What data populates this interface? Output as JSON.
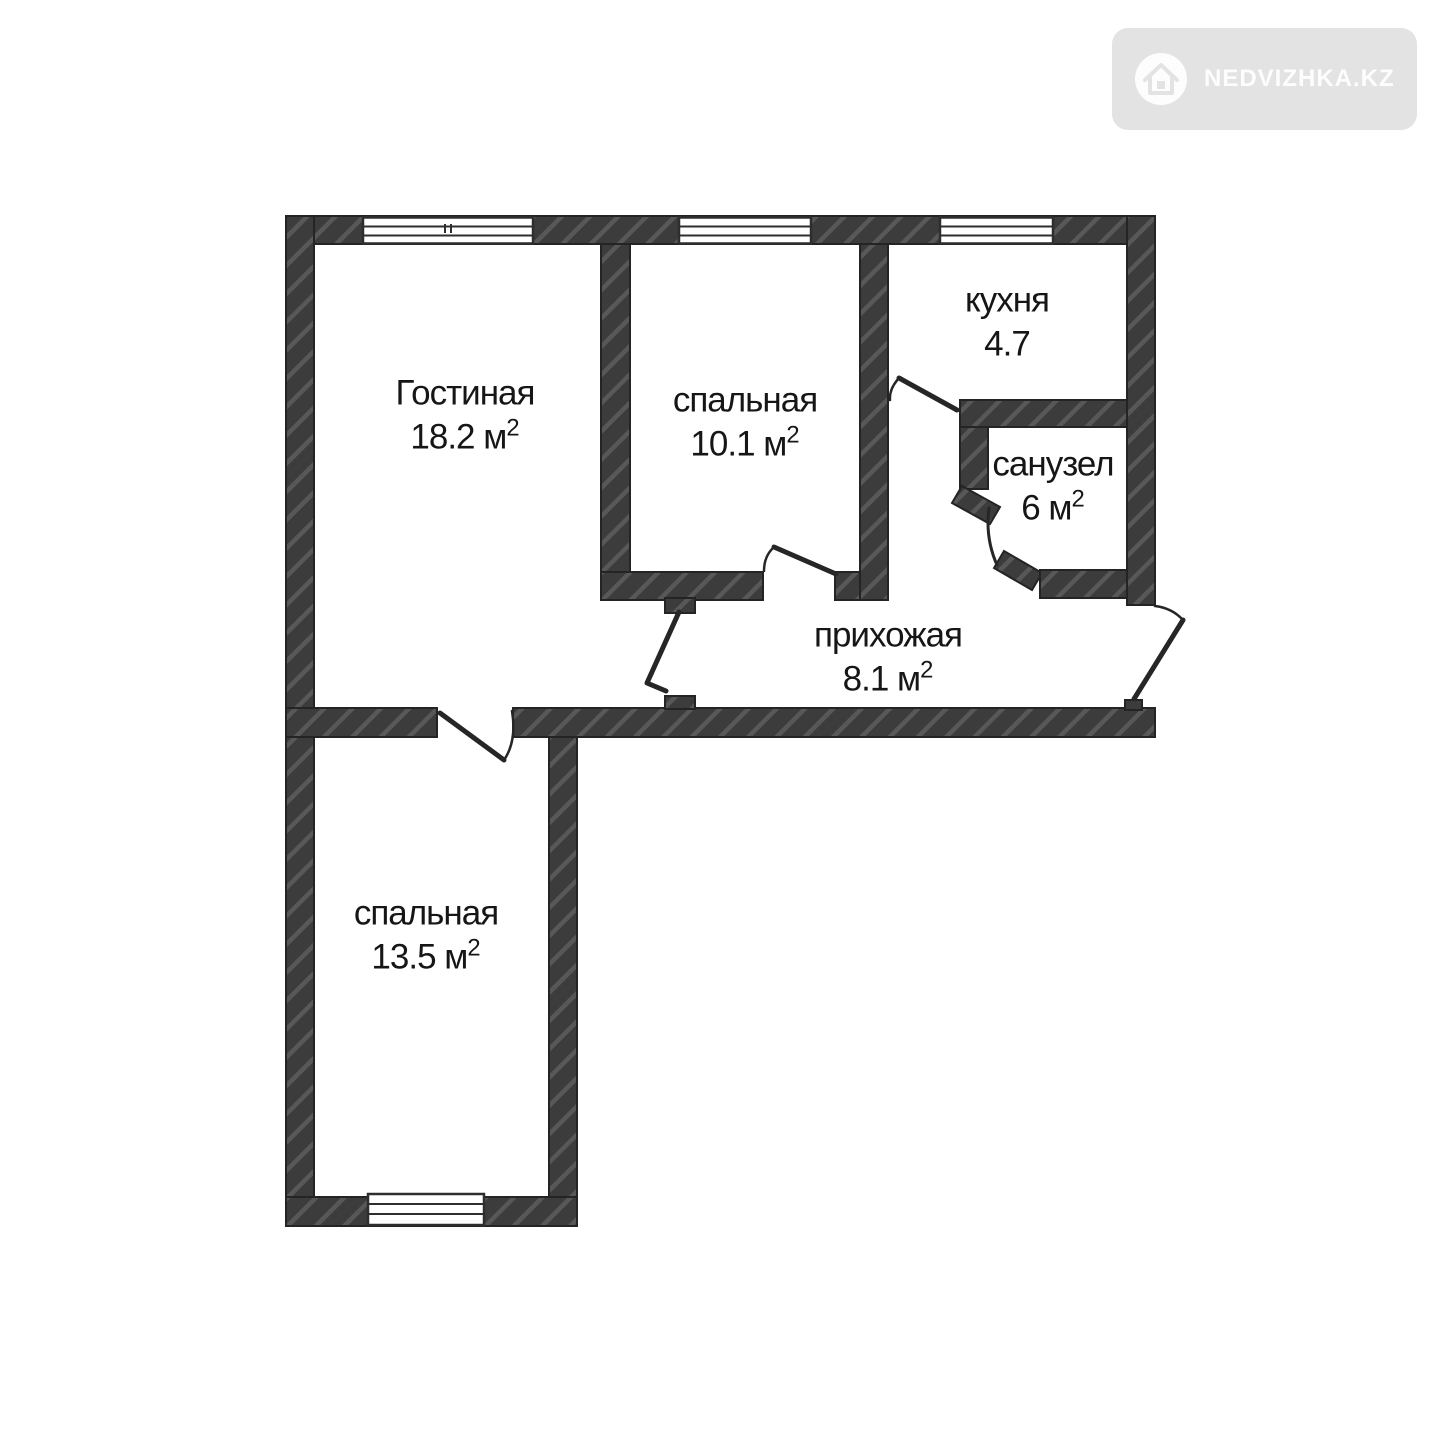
{
  "watermark": {
    "brand": "NEDVIZHKA.KZ",
    "icon": "house-icon",
    "bg_color": "#e3e3e3",
    "fg_color": "#fdfdfd"
  },
  "plan": {
    "type": "apartment-floorplan",
    "wall_color": "#3c3c3c",
    "hatch_color": "#585858",
    "line_color": "#262626",
    "rooms": [
      {
        "id": "living",
        "label": "Гостиная",
        "area": "18.2 м",
        "sup": "2"
      },
      {
        "id": "bedroom-top",
        "label": "спальная",
        "area": "10.1 м",
        "sup": "2"
      },
      {
        "id": "kitchen",
        "label": "кухня",
        "area": "4.7",
        "sup": ""
      },
      {
        "id": "bathroom",
        "label": "санузел",
        "area": "6 м",
        "sup": "2"
      },
      {
        "id": "hallway",
        "label": "прихожая",
        "area": "8.1 м",
        "sup": "2"
      },
      {
        "id": "bedroom-bottom",
        "label": "спальная",
        "area": "13.5 м",
        "sup": "2"
      }
    ]
  }
}
